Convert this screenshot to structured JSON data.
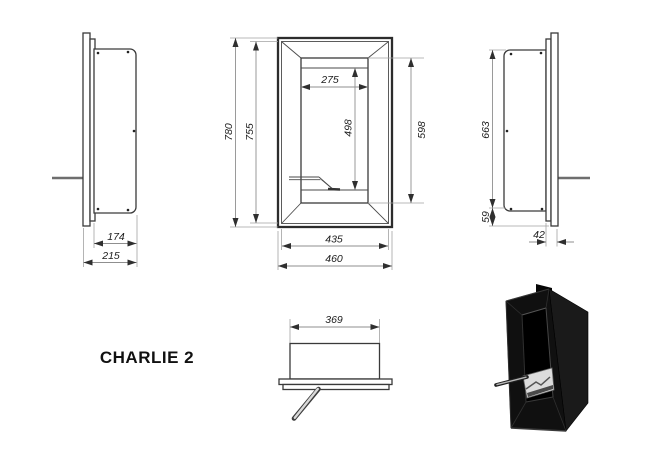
{
  "title": "CHARLIE 2",
  "dims": {
    "left_view": {
      "recess_depth": "174",
      "total_depth": "215"
    },
    "front_view": {
      "total_height": "780",
      "frame_height": "755",
      "opening_width": "275",
      "inner_height": "498",
      "opening_height": "598",
      "frame_width": "435",
      "total_width": "460"
    },
    "right_view": {
      "body_height": "663",
      "bottom_offset": "59",
      "frame_depth": "42"
    },
    "top_view": {
      "burner_width": "369"
    }
  },
  "colors": {
    "background": "#ffffff",
    "object_line": "#3a3a3a",
    "dimension_line": "#8f8f8f",
    "dimension_text": "#1c1c1c",
    "render_black": "#0d0d0d"
  }
}
